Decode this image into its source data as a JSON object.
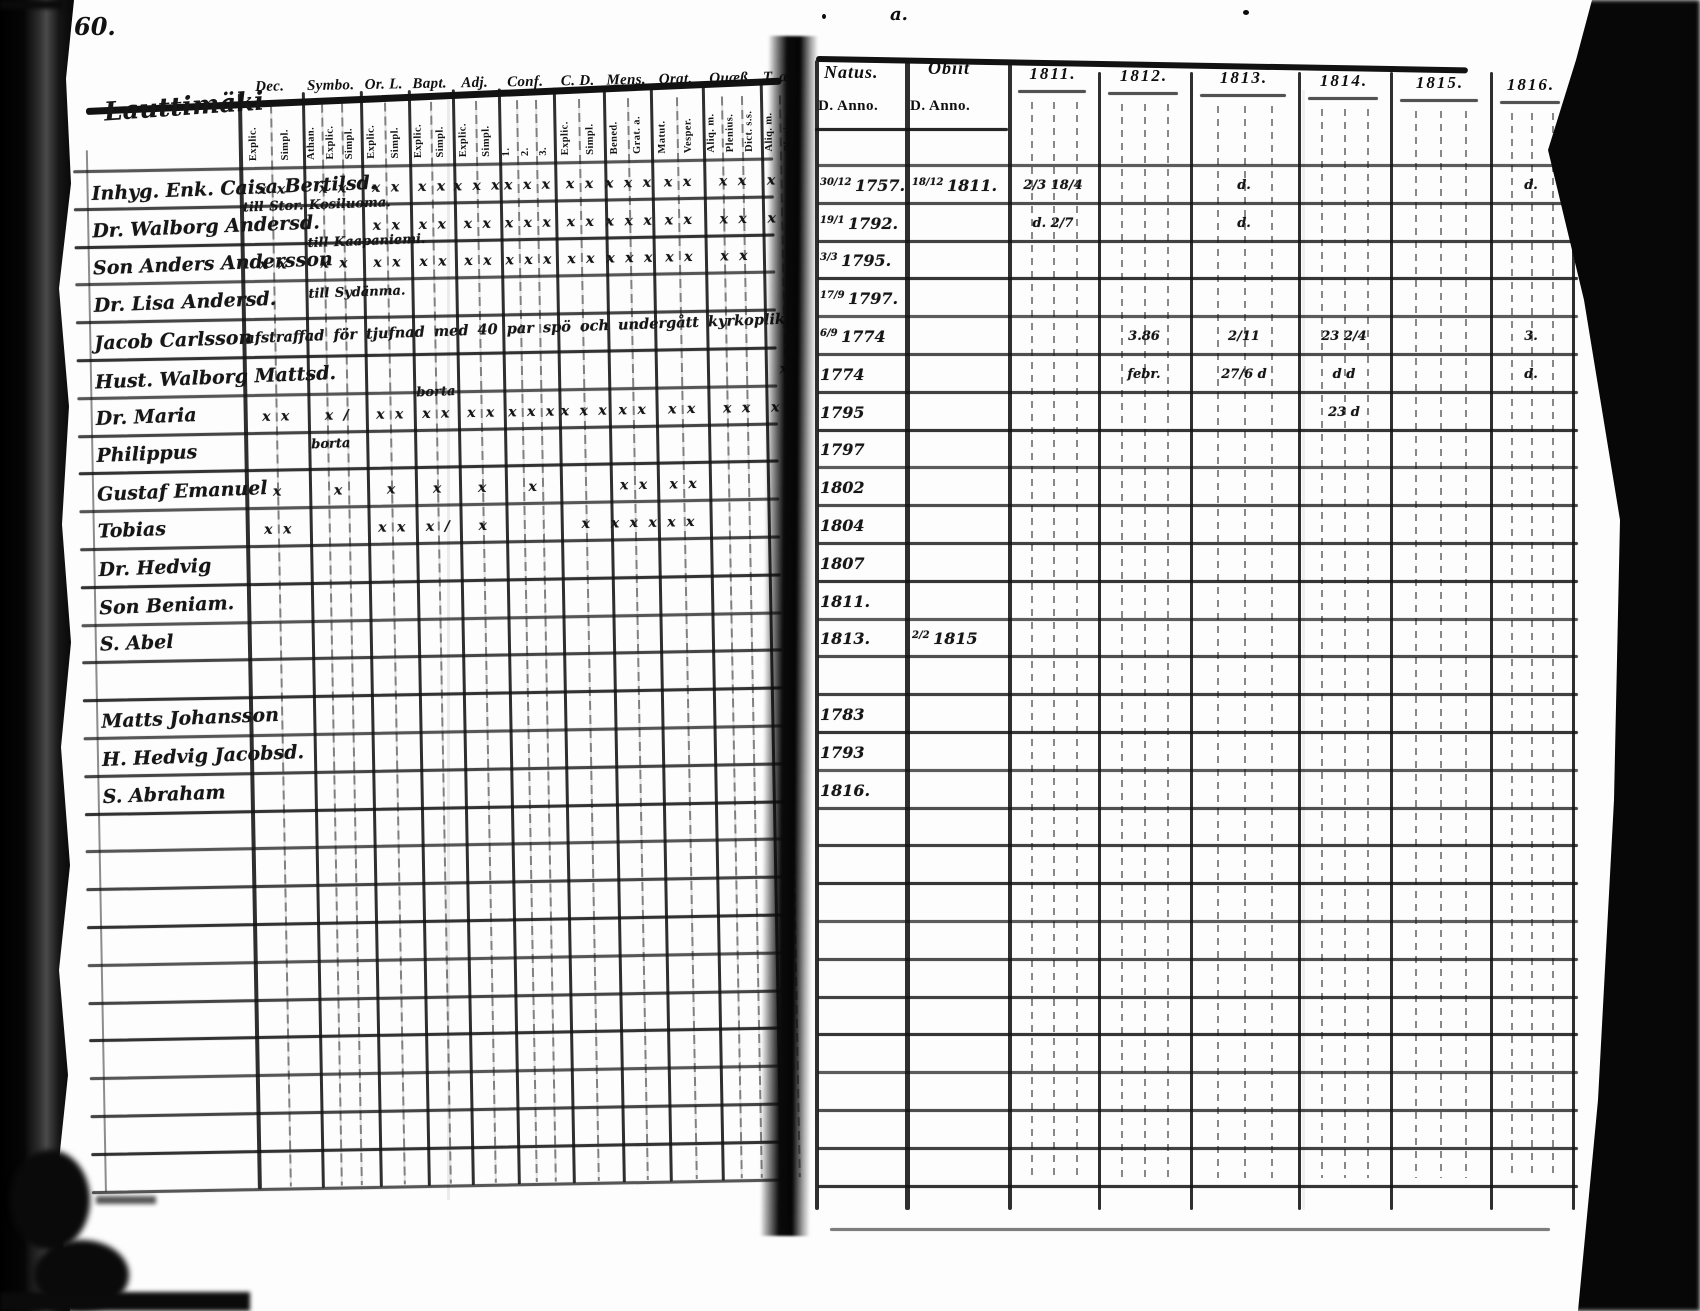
{
  "page": {
    "number": "60.",
    "place_name": "Lauttimäki",
    "type_note": "handwritten parish communion register, two-page spread"
  },
  "ink_marks": {
    "top_center": "a."
  },
  "left_table": {
    "column_groups": [
      {
        "label": "Dec.",
        "subs": [
          "Explic.",
          "Simpl."
        ]
      },
      {
        "label": "Symbo.",
        "subs": [
          "Athan.",
          "Explic.",
          "Simpl."
        ]
      },
      {
        "label": "Or. L.",
        "subs": [
          "Explic.",
          "Simpl."
        ]
      },
      {
        "label": "Bapt.",
        "subs": [
          "Explic.",
          "Simpl."
        ]
      },
      {
        "label": "Adj.",
        "subs": [
          "Explic.",
          "Simpl."
        ]
      },
      {
        "label": "Conf.",
        "subs": [
          "1.",
          "2.",
          "3."
        ]
      },
      {
        "label": "C. D.",
        "subs": [
          "Explic.",
          "Simpl."
        ]
      },
      {
        "label": "Mens.",
        "subs": [
          "Bened.",
          "Grat. a."
        ]
      },
      {
        "label": "Orat.",
        "subs": [
          "Matut.",
          "Vesper."
        ]
      },
      {
        "label": "Quæß.",
        "subs": [
          "Aliq. m.",
          "Plenius.",
          "Dict. s.s."
        ]
      },
      {
        "label": "T. æ.",
        "subs": [
          "Aliq. m.",
          "Plenius."
        ]
      }
    ],
    "rows": [
      {
        "name": "Inhyg. Enk. Caisa Bertilsd.",
        "note": "",
        "note_g": 0,
        "marks": [
          "x x",
          "x x",
          "x x",
          "x x",
          "x x x",
          "x x x",
          "x x",
          "x x x",
          "x x",
          "x x",
          "x x"
        ]
      },
      {
        "name": "Dr. Walborg Andersd.",
        "note": "till Stor. Kosiluoma.",
        "note_g": 0,
        "marks": [
          "",
          "",
          "x x",
          "x x",
          "x x",
          "x x x",
          "x x",
          "x x x",
          "x x",
          "x x",
          "x x"
        ]
      },
      {
        "name": "Son Anders Andersson",
        "note": "till Kaapaniemi.",
        "note_g": 1,
        "marks": [
          "x x",
          "x x",
          "x x",
          "x x",
          "x x",
          "x x x",
          "x x",
          "x x x",
          "x x",
          "x x",
          ""
        ]
      },
      {
        "name": "Dr. Lisa Andersd.",
        "note": "till Sydänma.",
        "note_g": 1,
        "marks": [
          "",
          "",
          "",
          "",
          "",
          "",
          "",
          "",
          "",
          "",
          ""
        ]
      },
      {
        "name": "Jacob Carlsson",
        "note": "afstraffad för tjufnad med 40 par spö och undergått kyrkoplikt",
        "note_g": 0,
        "marks": [
          "",
          "",
          "",
          "",
          "",
          "",
          "",
          "",
          "",
          "",
          ""
        ]
      },
      {
        "name": "Hust. Walborg Mattsd.",
        "note": "",
        "note_g": 0,
        "marks": [
          "",
          "",
          "",
          "",
          "",
          "",
          "",
          "",
          "",
          "",
          "x"
        ]
      },
      {
        "name": "Dr. Maria",
        "note": "borta",
        "note_g": 3,
        "marks": [
          "x x",
          "x /",
          "x x",
          "x x",
          "x x",
          "x x x",
          "x x x",
          "x x",
          "x x",
          "x x",
          "x x"
        ]
      },
      {
        "name": "Philippus",
        "note": "borta",
        "note_g": 1,
        "marks": [
          "",
          "",
          "",
          "",
          "",
          "",
          "",
          "",
          "",
          "",
          ""
        ]
      },
      {
        "name": "Gustaf Emanuel",
        "note": "",
        "note_g": 0,
        "marks": [
          "x",
          "x",
          "x",
          "x",
          "x",
          "x",
          "",
          "x x",
          "x x",
          "",
          ""
        ]
      },
      {
        "name": "Tobias",
        "note": "",
        "note_g": 0,
        "marks": [
          "x x",
          "",
          "x x",
          "x /",
          "x",
          "",
          "x",
          "x x x x x",
          "",
          "",
          ""
        ]
      },
      {
        "name": "Dr. Hedvig",
        "note": "",
        "note_g": 0,
        "marks": [
          "",
          "",
          "",
          "",
          "",
          "",
          "",
          "",
          "",
          "",
          ""
        ]
      },
      {
        "name": "Son Beniam.",
        "note": "",
        "note_g": 0,
        "marks": [
          "",
          "",
          "",
          "",
          "",
          "",
          "",
          "",
          "",
          "",
          ""
        ]
      },
      {
        "name": "S. Abel",
        "note": "",
        "note_g": 0,
        "marks": [
          "",
          "",
          "",
          "",
          "",
          "",
          "",
          "",
          "",
          "",
          ""
        ]
      },
      {
        "name": "Matts Johansson",
        "note": "",
        "note_g": 0,
        "marks": [
          "",
          "",
          "",
          "",
          "",
          "",
          "",
          "",
          "",
          "",
          ""
        ]
      },
      {
        "name": "H. Hedvig Jacobsd.",
        "note": "",
        "note_g": 0,
        "marks": [
          "",
          "",
          "",
          "",
          "",
          "",
          "",
          "",
          "",
          "",
          ""
        ]
      },
      {
        "name": "S. Abraham",
        "note": "",
        "note_g": 0,
        "marks": [
          "",
          "",
          "",
          "",
          "",
          "",
          "",
          "",
          "",
          "",
          ""
        ]
      }
    ]
  },
  "right_table": {
    "natus_label": "Natus.",
    "obiit_label": "Obiit",
    "anno_label": "D. Anno.",
    "years": [
      "1811.",
      "1812.",
      "1813.",
      "1814.",
      "1815.",
      "1816."
    ],
    "rows": [
      {
        "natus_d": "30/12",
        "natus_y": "1757.",
        "obiit_d": "18/12",
        "obiit_y": "1811.",
        "entries": {
          "1811.": "2/3  18/4",
          "1813.": "d.",
          "1816.": "d."
        }
      },
      {
        "natus_d": "19/1",
        "natus_y": "1792.",
        "obiit_d": "",
        "obiit_y": "",
        "entries": {
          "1811.": "d. 2/7",
          "1813.": "d."
        }
      },
      {
        "natus_d": "3/3",
        "natus_y": "1795.",
        "obiit_d": "",
        "obiit_y": "",
        "entries": {}
      },
      {
        "natus_d": "17/9",
        "natus_y": "1797.",
        "obiit_d": "",
        "obiit_y": "",
        "entries": {}
      },
      {
        "natus_d": "6/9",
        "natus_y": "1774",
        "obiit_d": "",
        "obiit_y": "",
        "entries": {
          "1812.": "3.86",
          "1813.": "2/11",
          "1814.": "23 2/4",
          "1816.": "3."
        }
      },
      {
        "natus_d": "",
        "natus_y": "1774",
        "obiit_d": "",
        "obiit_y": "",
        "entries": {
          "1812.": "febr.",
          "1813.": "27/6 d",
          "1814.": "d d",
          "1816.": "d."
        }
      },
      {
        "natus_d": "",
        "natus_y": "1795",
        "obiit_d": "",
        "obiit_y": "",
        "entries": {
          "1814.": "23 d"
        }
      },
      {
        "natus_d": "",
        "natus_y": "1797",
        "obiit_d": "",
        "obiit_y": "",
        "entries": {}
      },
      {
        "natus_d": "",
        "natus_y": "1802",
        "obiit_d": "",
        "obiit_y": "",
        "entries": {}
      },
      {
        "natus_d": "",
        "natus_y": "1804",
        "obiit_d": "",
        "obiit_y": "",
        "entries": {}
      },
      {
        "natus_d": "",
        "natus_y": "1807",
        "obiit_d": "",
        "obiit_y": "",
        "entries": {}
      },
      {
        "natus_d": "",
        "natus_y": "1811.",
        "obiit_d": "",
        "obiit_y": "",
        "entries": {}
      },
      {
        "natus_d": "",
        "natus_y": "1813.",
        "obiit_d": "2/2",
        "obiit_y": "1815",
        "entries": {}
      },
      {
        "natus_d": "",
        "natus_y": "1783",
        "obiit_d": "",
        "obiit_y": "",
        "entries": {}
      },
      {
        "natus_d": "",
        "natus_y": "1793",
        "obiit_d": "",
        "obiit_y": "",
        "entries": {}
      },
      {
        "natus_d": "",
        "natus_y": "1816.",
        "obiit_d": "",
        "obiit_y": "",
        "entries": {}
      }
    ]
  }
}
